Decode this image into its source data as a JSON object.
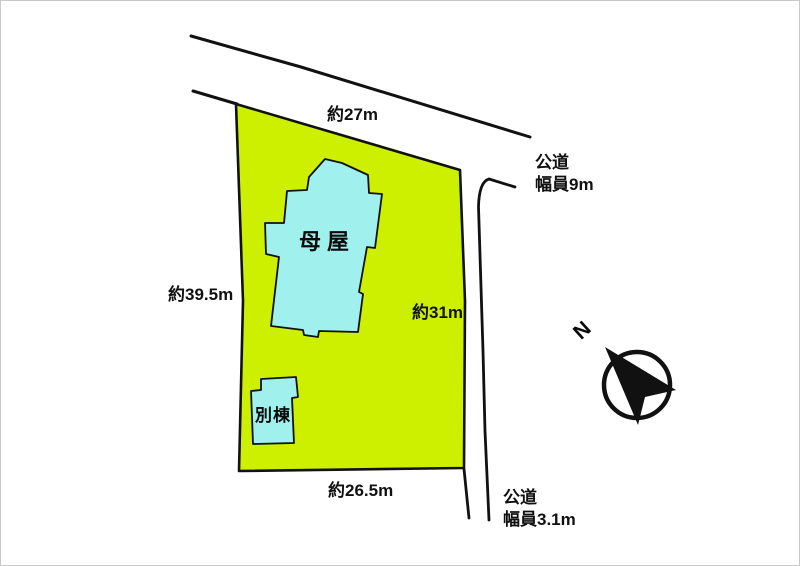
{
  "diagram": {
    "kind": "land-plot-layout",
    "site": {
      "dimensions": {
        "top": "約27m",
        "left": "約39.5m",
        "right": "約31m",
        "bottom": "約26.5m"
      },
      "buildings": [
        {
          "id": "main-house",
          "label": "母屋"
        },
        {
          "id": "annex",
          "label": "別棟"
        }
      ]
    },
    "roads": [
      {
        "position": "top-right",
        "type": "公道",
        "width": "幅員9m"
      },
      {
        "position": "bottom-right",
        "type": "公道",
        "width": "幅員3.1m"
      }
    ],
    "compass": {
      "north_label": "N"
    },
    "colors": {
      "site_fill": "#ccf000",
      "building_fill": "#a0f0ee",
      "outline": "#111111",
      "background": "#ffffff"
    }
  }
}
